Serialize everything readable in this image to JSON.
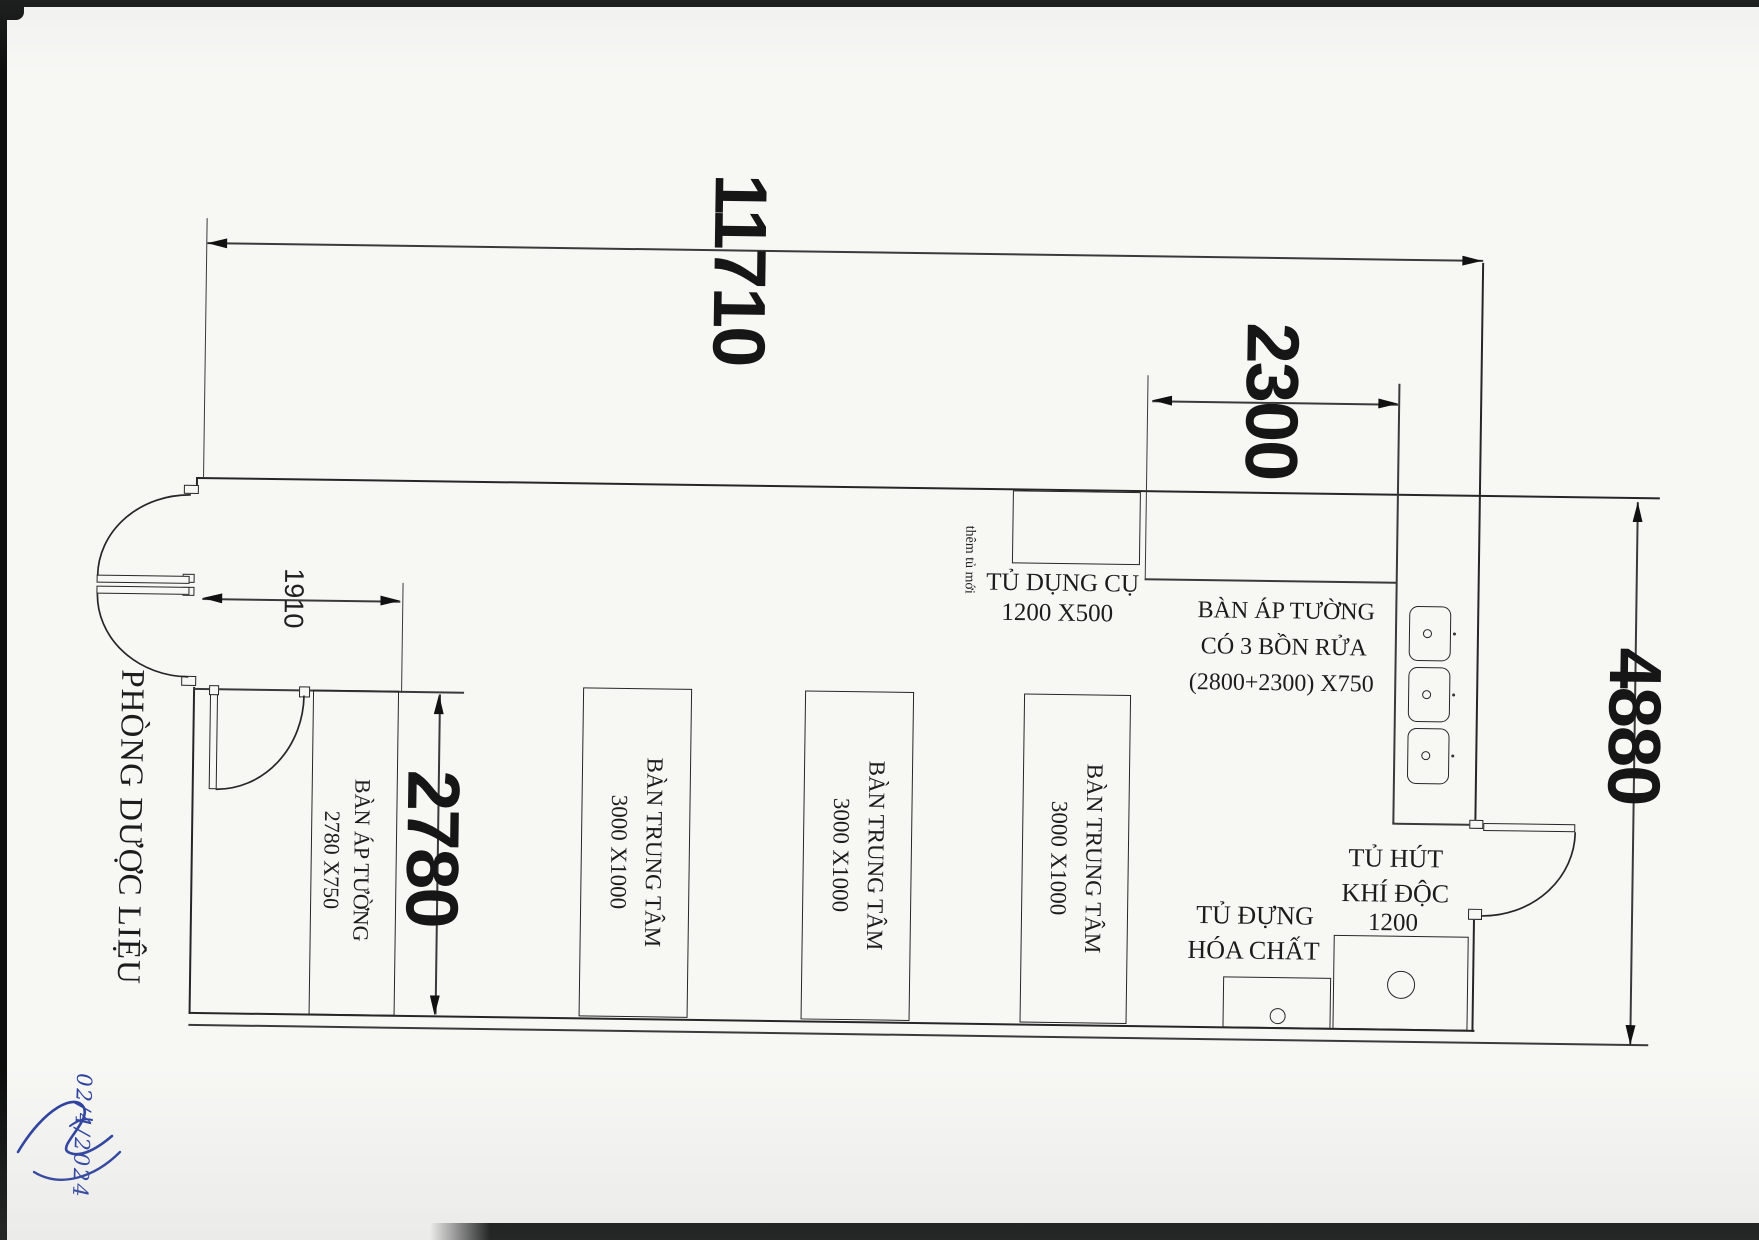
{
  "drawing": {
    "room_label": "PHÒNG DƯỢC LIỆU",
    "handwritten_date": "02/4/2024"
  },
  "dimensions": {
    "overall_width": "11710",
    "sink_run": "2300",
    "overall_depth": "4880",
    "wall_bench_len": "2780",
    "entry_clear": "1910"
  },
  "furniture": {
    "tool_cabinet": {
      "name": "TỦ DỤNG CỤ",
      "size": "1200 X500"
    },
    "new_cabinet_note": "thêm tủ mới",
    "sink_bench": {
      "line1": "BÀN ÁP TƯỜNG",
      "line2": "CÓ 3 BỒN RỬA",
      "line3": "(2800+2300) X750"
    },
    "wall_bench": {
      "line1": "BÀN ÁP TƯỜNG",
      "line2": "2780 X750"
    },
    "center_table": {
      "line1": "BÀN TRUNG TÂM",
      "line2": "3000 X1000",
      "count": 3
    },
    "fume_hood": {
      "line1": "TỦ HÚT",
      "line2": "KHÍ ĐỘC",
      "line3": "1200"
    },
    "chemical_cabinet": {
      "line1": "TỦ ĐỰNG",
      "line2": "HÓA CHẤT"
    }
  },
  "colors": {
    "ink": "#262626",
    "blue_ink": "#2b3f9e",
    "paper": "#f7f7f4"
  }
}
